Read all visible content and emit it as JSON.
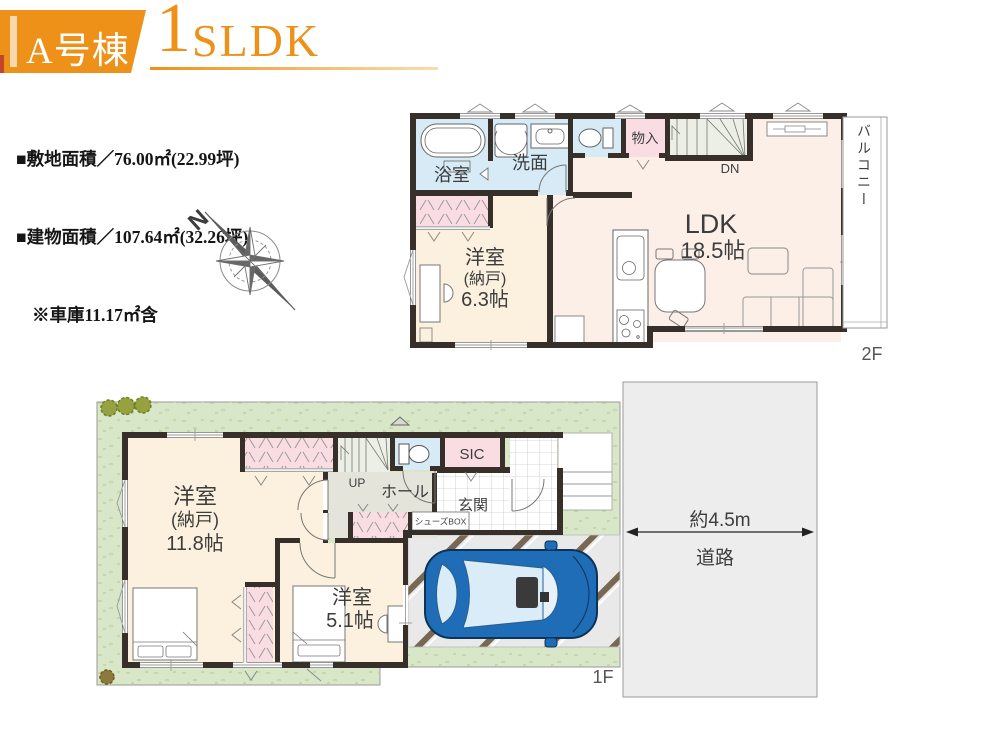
{
  "header": {
    "badge": "A号棟",
    "plan_number": "1",
    "plan_letters": "SLDK"
  },
  "site_info": {
    "line1": "■敷地面積／76.00㎡(22.99坪)",
    "line2": "■建物面積／107.64㎡(32.26坪)",
    "line3": "※車庫11.17㎡含"
  },
  "compass": {
    "north": "N"
  },
  "floor2": {
    "floor_label": "2F",
    "bath": "浴室",
    "washroom": "洗面",
    "storage": "物入",
    "stairs": "DN",
    "ldk": "LDK",
    "ldk_size": "18.5帖",
    "balcony": "バルコニー",
    "bedroom": "洋室",
    "bedroom_sub": "(納戸)",
    "bedroom_size": "6.3帖"
  },
  "floor1": {
    "floor_label": "1F",
    "bedroom1": "洋室",
    "bedroom1_sub": "(納戸)",
    "bedroom1_size": "11.8帖",
    "bedroom2": "洋室",
    "bedroom2_size": "5.1帖",
    "hall": "ホール",
    "stairs": "UP",
    "entrance": "玄関",
    "sic": "SIC",
    "shoes_box": "シューズBOX",
    "road_width": "約4.5m",
    "road": "道路"
  },
  "colors": {
    "accent": "#ee9118",
    "wall": "#37302a",
    "floor_cream": "#fbf1de",
    "floor_pink": "#fcefe8",
    "water": "#d6ebf6",
    "closet": "#f9dde2",
    "stairs": "#ecefe5",
    "hall": "#e4e4da",
    "lawn": "#d8e7c7",
    "road": "#ededed",
    "garage": "#e9e9e9",
    "stripe": "#786853",
    "car": "#1e6db6",
    "glass": "#d9ecf7"
  }
}
